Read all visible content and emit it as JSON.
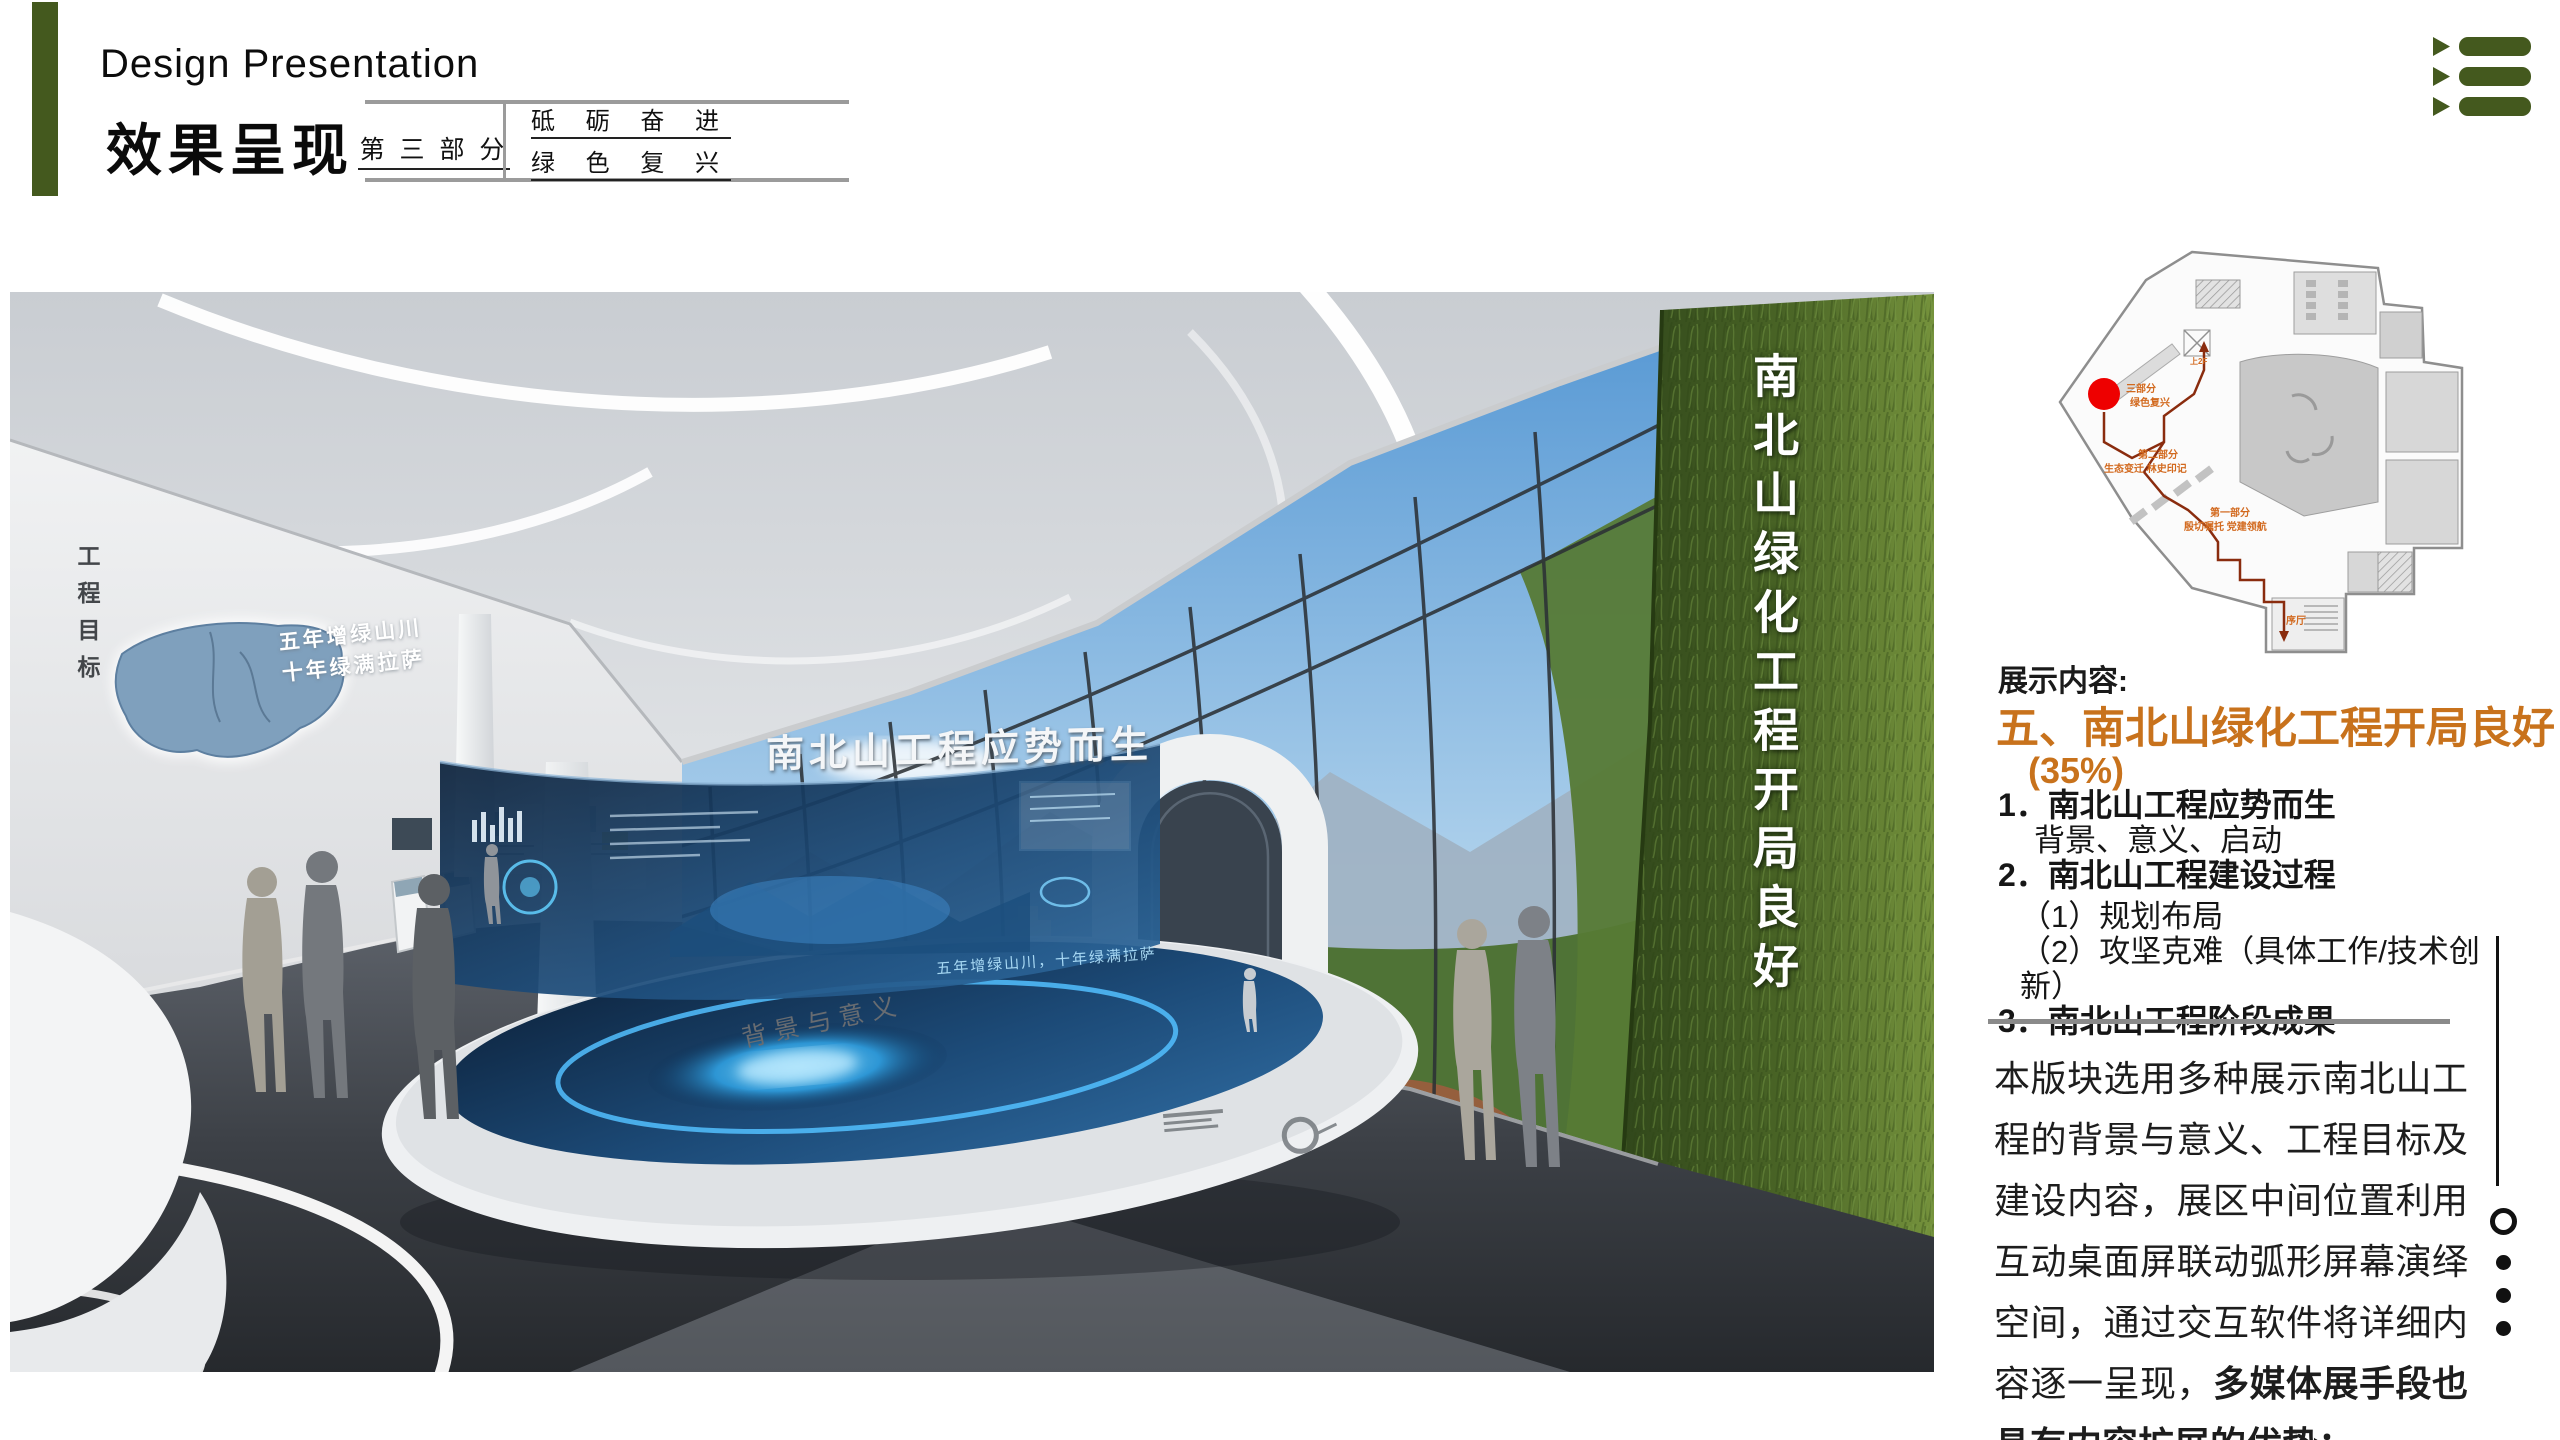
{
  "header": {
    "subtitle_en": "Design Presentation",
    "title_cn": "效果呈现",
    "part_label": "第 三 部 分",
    "part_theme_line1": "砥 砺 奋 进",
    "part_theme_line2": "绿 色 复 兴"
  },
  "menu_icon": "list-menu-icon",
  "rendering": {
    "left_wall_vertical_text": "工程目标",
    "wall_slogan_line1": "五年增绿山川",
    "wall_slogan_line2": "十年绿满拉萨",
    "screen_title": "南北山工程应势而生",
    "table_label": "背景与意义",
    "table_screen_text": "五年增绿山川，十年绿满拉萨",
    "green_wall_vertical_text": "南北山绿化工程开局良好"
  },
  "floor_plan": {
    "marker_color": "#EE0000",
    "route_color": "#8A2C0E",
    "labels": {
      "part3_line1": "三部分",
      "part3_line2": "绿色复兴",
      "part2_line1": "第二部分",
      "part2_line2": "生态变迁 林史印记",
      "part1_line1": "第一部分",
      "part1_line2": "殷切嘱托 党建领航",
      "lobby": "序厅",
      "to_2f": "上2F"
    }
  },
  "content": {
    "section_label": "展示内容:",
    "heading": "五、南北山绿化工程开局良好",
    "percentage": "(35%)",
    "items": [
      {
        "text": "1．南北山工程应势而生"
      },
      {
        "text": "背景、意义、启动"
      },
      {
        "text": "2．南北山工程建设过程"
      },
      {
        "text": "（1）规划布局"
      },
      {
        "text": "（2）攻坚克难（具体工作/技术创新）"
      },
      {
        "text": "3．南北山工程阶段成果"
      }
    ],
    "paragraph_regular": "本版块选用多种展示南北山工程的背景与意义、工程目标及建设内容，展区中间位置利用互动桌面屏联动弧形屏幕演绎空间，通过交互软件将详细内容逐一呈现，",
    "paragraph_bold": "多媒体展手段也具有内容扩展的优势；"
  },
  "colors": {
    "accent_green": "#44591E",
    "accent_orange": "#C8721C",
    "table_line_gray": "#9B9B9B"
  },
  "pagination": {
    "dots": [
      "outline",
      "filled",
      "filled",
      "filled"
    ]
  }
}
